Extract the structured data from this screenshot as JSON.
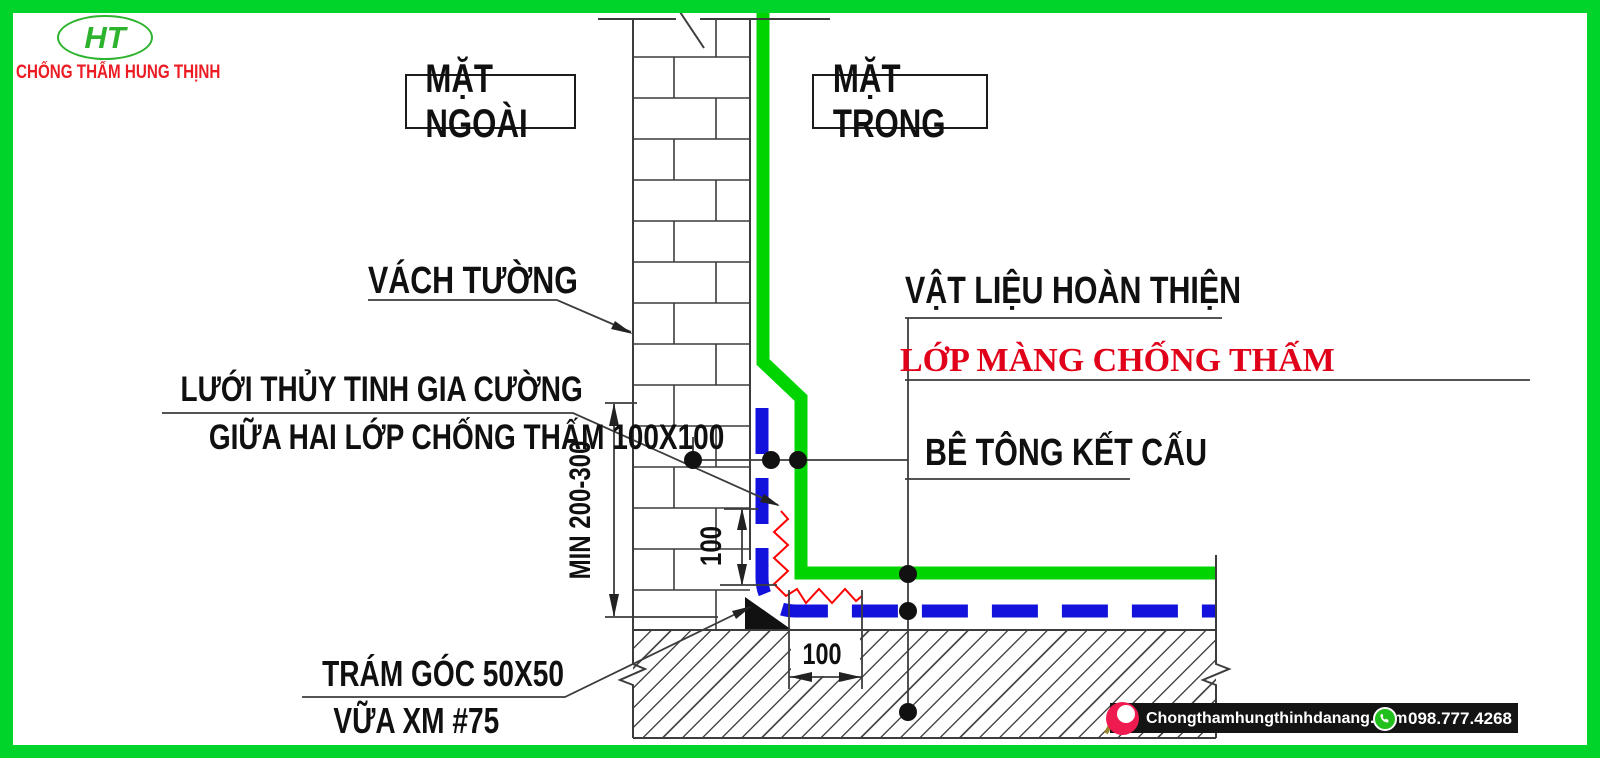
{
  "brand": {
    "monogram": "HT",
    "name": "CHỐNG THẤM HUNG THỊNH"
  },
  "faces": {
    "outside": "MẶT NGOÀI",
    "inside": "MẶT TRONG"
  },
  "callouts": {
    "wall": "VÁCH TƯỜNG",
    "mesh_line1": "LƯỚI THỦY TINH GIA CƯỜNG",
    "mesh_line2": "GIỮA HAI LỚP CHỐNG THẤM 100X100",
    "finish_material": "VẬT LIỆU HOÀN THIỆN",
    "membrane": "LỚP MÀNG CHỐNG THẤM",
    "structural_concrete": "BÊ TÔNG KẾT CẤU",
    "corner_fill_line1": "TRÁM GÓC 50X50",
    "corner_fill_line2": "VỮA XM #75"
  },
  "dimensions": {
    "min_wall_height": "MIN 200-300",
    "up_wall_return": "100",
    "floor_return": "100"
  },
  "footer": {
    "website": "Chongthamhungthinhdanang.com",
    "phone": "098.777.4268"
  },
  "colors": {
    "frame_green": "#00d42a",
    "membrane_green": "#00d400",
    "membrane_blue": "#1212dc",
    "mesh_red": "#ff0000",
    "membrane_label_red": "#e10019",
    "brand_red": "#ec1c24",
    "logo_green": "#2db32d",
    "footer_bar": "#141414",
    "whatsapp_green": "#22c01e"
  }
}
